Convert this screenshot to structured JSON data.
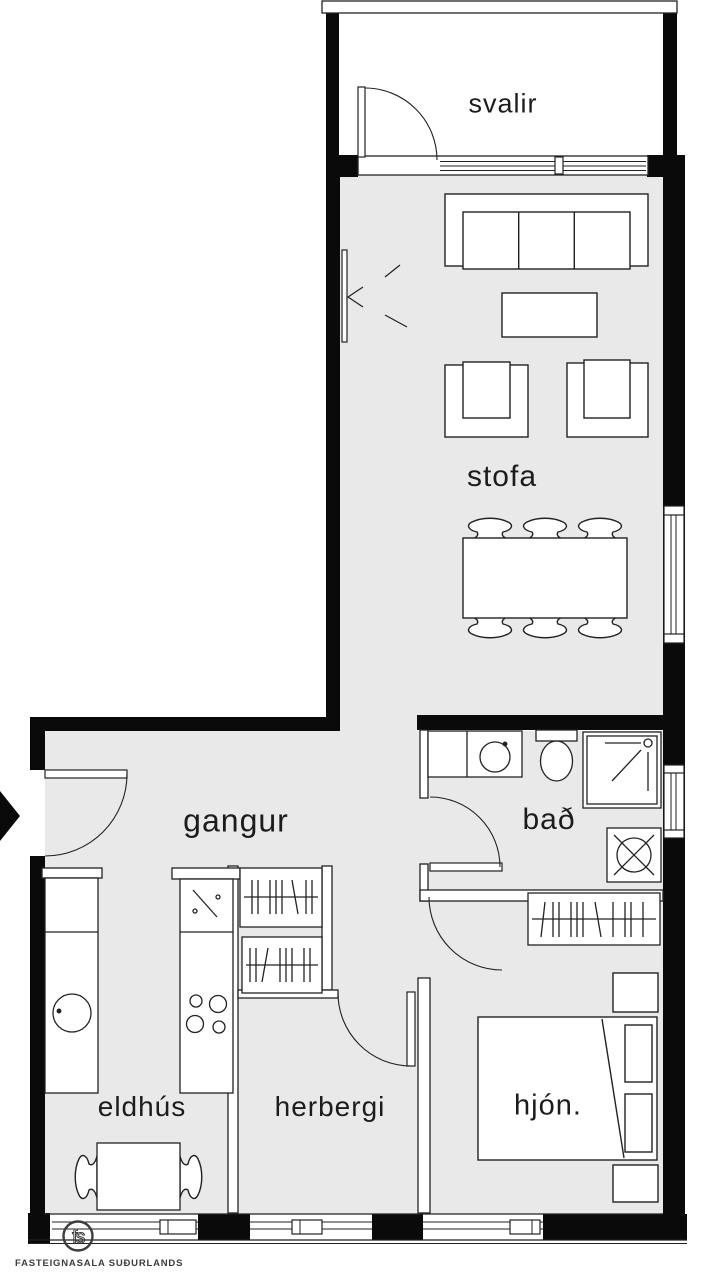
{
  "plan": {
    "rooms": [
      {
        "id": "svalir",
        "label": "svalir"
      },
      {
        "id": "stofa",
        "label": "stofa"
      },
      {
        "id": "gangur",
        "label": "gangur"
      },
      {
        "id": "bad",
        "label": "bað"
      },
      {
        "id": "eldhus",
        "label": "eldhús"
      },
      {
        "id": "herbergi",
        "label": "herbergi"
      },
      {
        "id": "hjon",
        "label": "hjón."
      }
    ],
    "branding": {
      "monogram": "fs",
      "name": "FASTEIGNASALA SUÐURLANDS"
    },
    "colors": {
      "wall": "#0a0a0a",
      "floor": "#e9e9e9",
      "line": "#222222",
      "logo_gray": "#3d3d3f"
    },
    "symbols": [
      "entry-arrow",
      "sofa",
      "coffee-table",
      "armchair",
      "dining-table-6-chairs",
      "tv-marker",
      "kitchen-counter-sink",
      "stove-4-burners",
      "kitchen-table-2-chairs",
      "wardrobe-hanging-rail",
      "vanity-sink",
      "toilet",
      "shower",
      "washing-machine",
      "double-bed",
      "nightstand",
      "window",
      "door-swing"
    ]
  }
}
